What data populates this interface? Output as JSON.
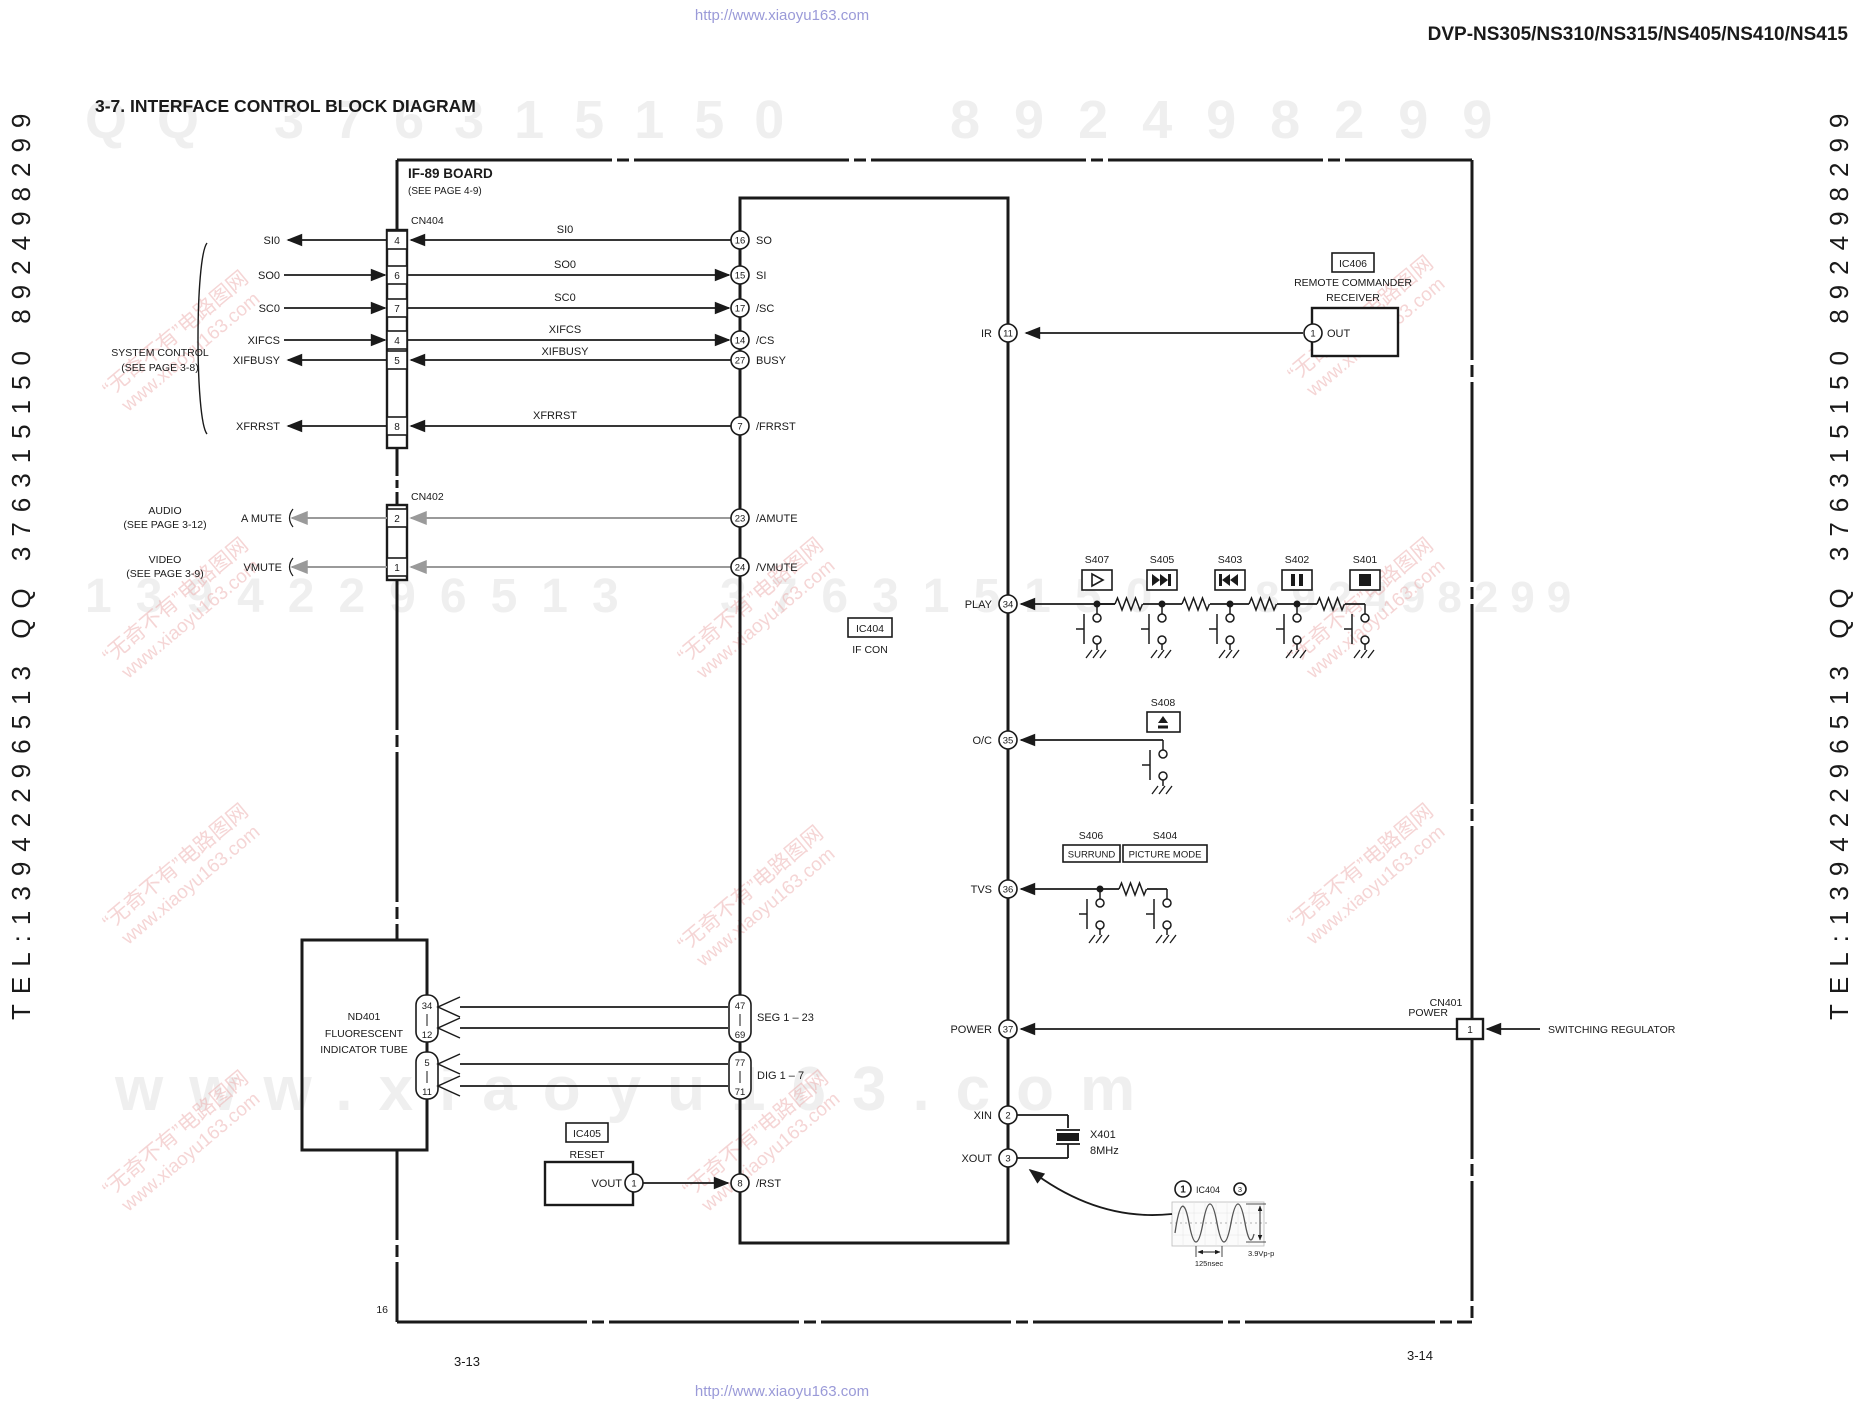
{
  "header": {
    "model": "DVP-NS305/NS310/NS315/NS405/NS410/NS415",
    "title": "3-7.  INTERFACE CONTROL BLOCK DIAGRAM"
  },
  "board": {
    "name": "IF-89 BOARD",
    "see_page": "(SEE PAGE 4-9)",
    "edge_pin": "16"
  },
  "footer": {
    "page_left": "3-13",
    "page_right": "3-14"
  },
  "system_control": {
    "line1": "SYSTEM CONTROL",
    "line2": "(SEE PAGE 3-8)"
  },
  "audio": {
    "line1": "AUDIO",
    "line2": "(SEE PAGE 3-12)",
    "signal": "A MUTE"
  },
  "video": {
    "line1": "VIDEO",
    "line2": "(SEE PAGE 3-9)",
    "signal": "VMUTE"
  },
  "cn404": {
    "ref": "CN404",
    "pin_si0": "4",
    "pin_so0": "6",
    "pin_sc0": "7",
    "pin_xifcs": "4",
    "pin_xifbusy": "5",
    "pin_xfrrst": "8",
    "left_si0": "SI0",
    "left_so0": "SO0",
    "left_sc0": "SC0",
    "left_xifcs": "XIFCS",
    "left_xifbusy": "XIFBUSY",
    "left_xfrrst": "XFRRST",
    "wire_si0": "SI0",
    "wire_so0": "SO0",
    "wire_sc0": "SC0",
    "wire_xifcs": "XIFCS",
    "wire_xifbusy": "XIFBUSY",
    "wire_xfrrst": "XFRRST"
  },
  "cn402": {
    "ref": "CN402",
    "pin_amute": "2",
    "pin_vmute": "1"
  },
  "cn401": {
    "ref": "CN401",
    "pin": "1",
    "label": "POWER",
    "dest": "SWITCHING REGULATOR"
  },
  "ic404": {
    "ref": "IC404",
    "name": "IF CON",
    "so": {
      "num": "16",
      "name": "SO"
    },
    "si": {
      "num": "15",
      "name": "SI"
    },
    "sc": {
      "num": "17",
      "name": "/SC"
    },
    "cs": {
      "num": "14",
      "name": "/CS"
    },
    "busy": {
      "num": "27",
      "name": "BUSY"
    },
    "frrst": {
      "num": "7",
      "name": "/FRRST"
    },
    "amute": {
      "num": "23",
      "name": "/AMUTE"
    },
    "vmute": {
      "num": "24",
      "name": "/VMUTE"
    },
    "rst": {
      "num": "8",
      "name": "/RST"
    },
    "ir": {
      "num": "11",
      "name": "IR"
    },
    "play": {
      "num": "34",
      "name": "PLAY"
    },
    "oc": {
      "num": "35",
      "name": "O/C"
    },
    "tvs": {
      "num": "36",
      "name": "TVS"
    },
    "power": {
      "num": "37",
      "name": "POWER"
    },
    "xin": {
      "num": "2",
      "name": "XIN"
    },
    "xout": {
      "num": "3",
      "name": "XOUT"
    },
    "seg": {
      "top": "47",
      "bot": "69",
      "name": "SEG 1 – 23"
    },
    "dig": {
      "top": "77",
      "bot": "71",
      "name": "DIG 1 – 7"
    }
  },
  "ic405": {
    "ref": "IC405",
    "name": "RESET",
    "pin": "1",
    "pin_name": "VOUT"
  },
  "ic406": {
    "ref": "IC406",
    "name1": "REMOTE COMMANDER",
    "name2": "RECEIVER",
    "pin": "1",
    "pin_name": "OUT"
  },
  "nd401": {
    "ref": "ND401",
    "name1": "FLUORESCENT",
    "name2": "INDICATOR TUBE",
    "p1top": "34",
    "p1bot": "12",
    "p2top": "5",
    "p2bot": "11"
  },
  "x401": {
    "ref": "X401",
    "freq": "8MHz"
  },
  "waveform": {
    "probe": "1",
    "ic": "IC404",
    "pin": "3",
    "period": "125nsec",
    "vpp": "3.9Vp-p"
  },
  "switches": {
    "s401": "S401",
    "s402": "S402",
    "s403": "S403",
    "s404": "S404",
    "s405": "S405",
    "s406": "S406",
    "s407": "S407",
    "s408": "S408",
    "s406_name": "SURRUND",
    "s404_name": "PICTURE MODE"
  },
  "watermark": {
    "url_top": "http://www.xiaoyu163.com",
    "url_bottom": "http://www.xiaoyu163.com",
    "giant_row1_left": "QQ 376315150",
    "giant_row1_right": "892498299",
    "giant_row2_left": "13942296513",
    "giant_row2_mid": "376315150",
    "giant_row2_right": "892498299",
    "giant_row3": "www.xiaoyu163.com",
    "edge_left": "TEL:13942296513  QQ 376315150  892498299",
    "edge_right": "TEL:13942296513  QQ 376315150  892498299",
    "pink_line1": "“无奇不有”电路图网",
    "pink_line2": "www.xiaoyu163.com"
  }
}
